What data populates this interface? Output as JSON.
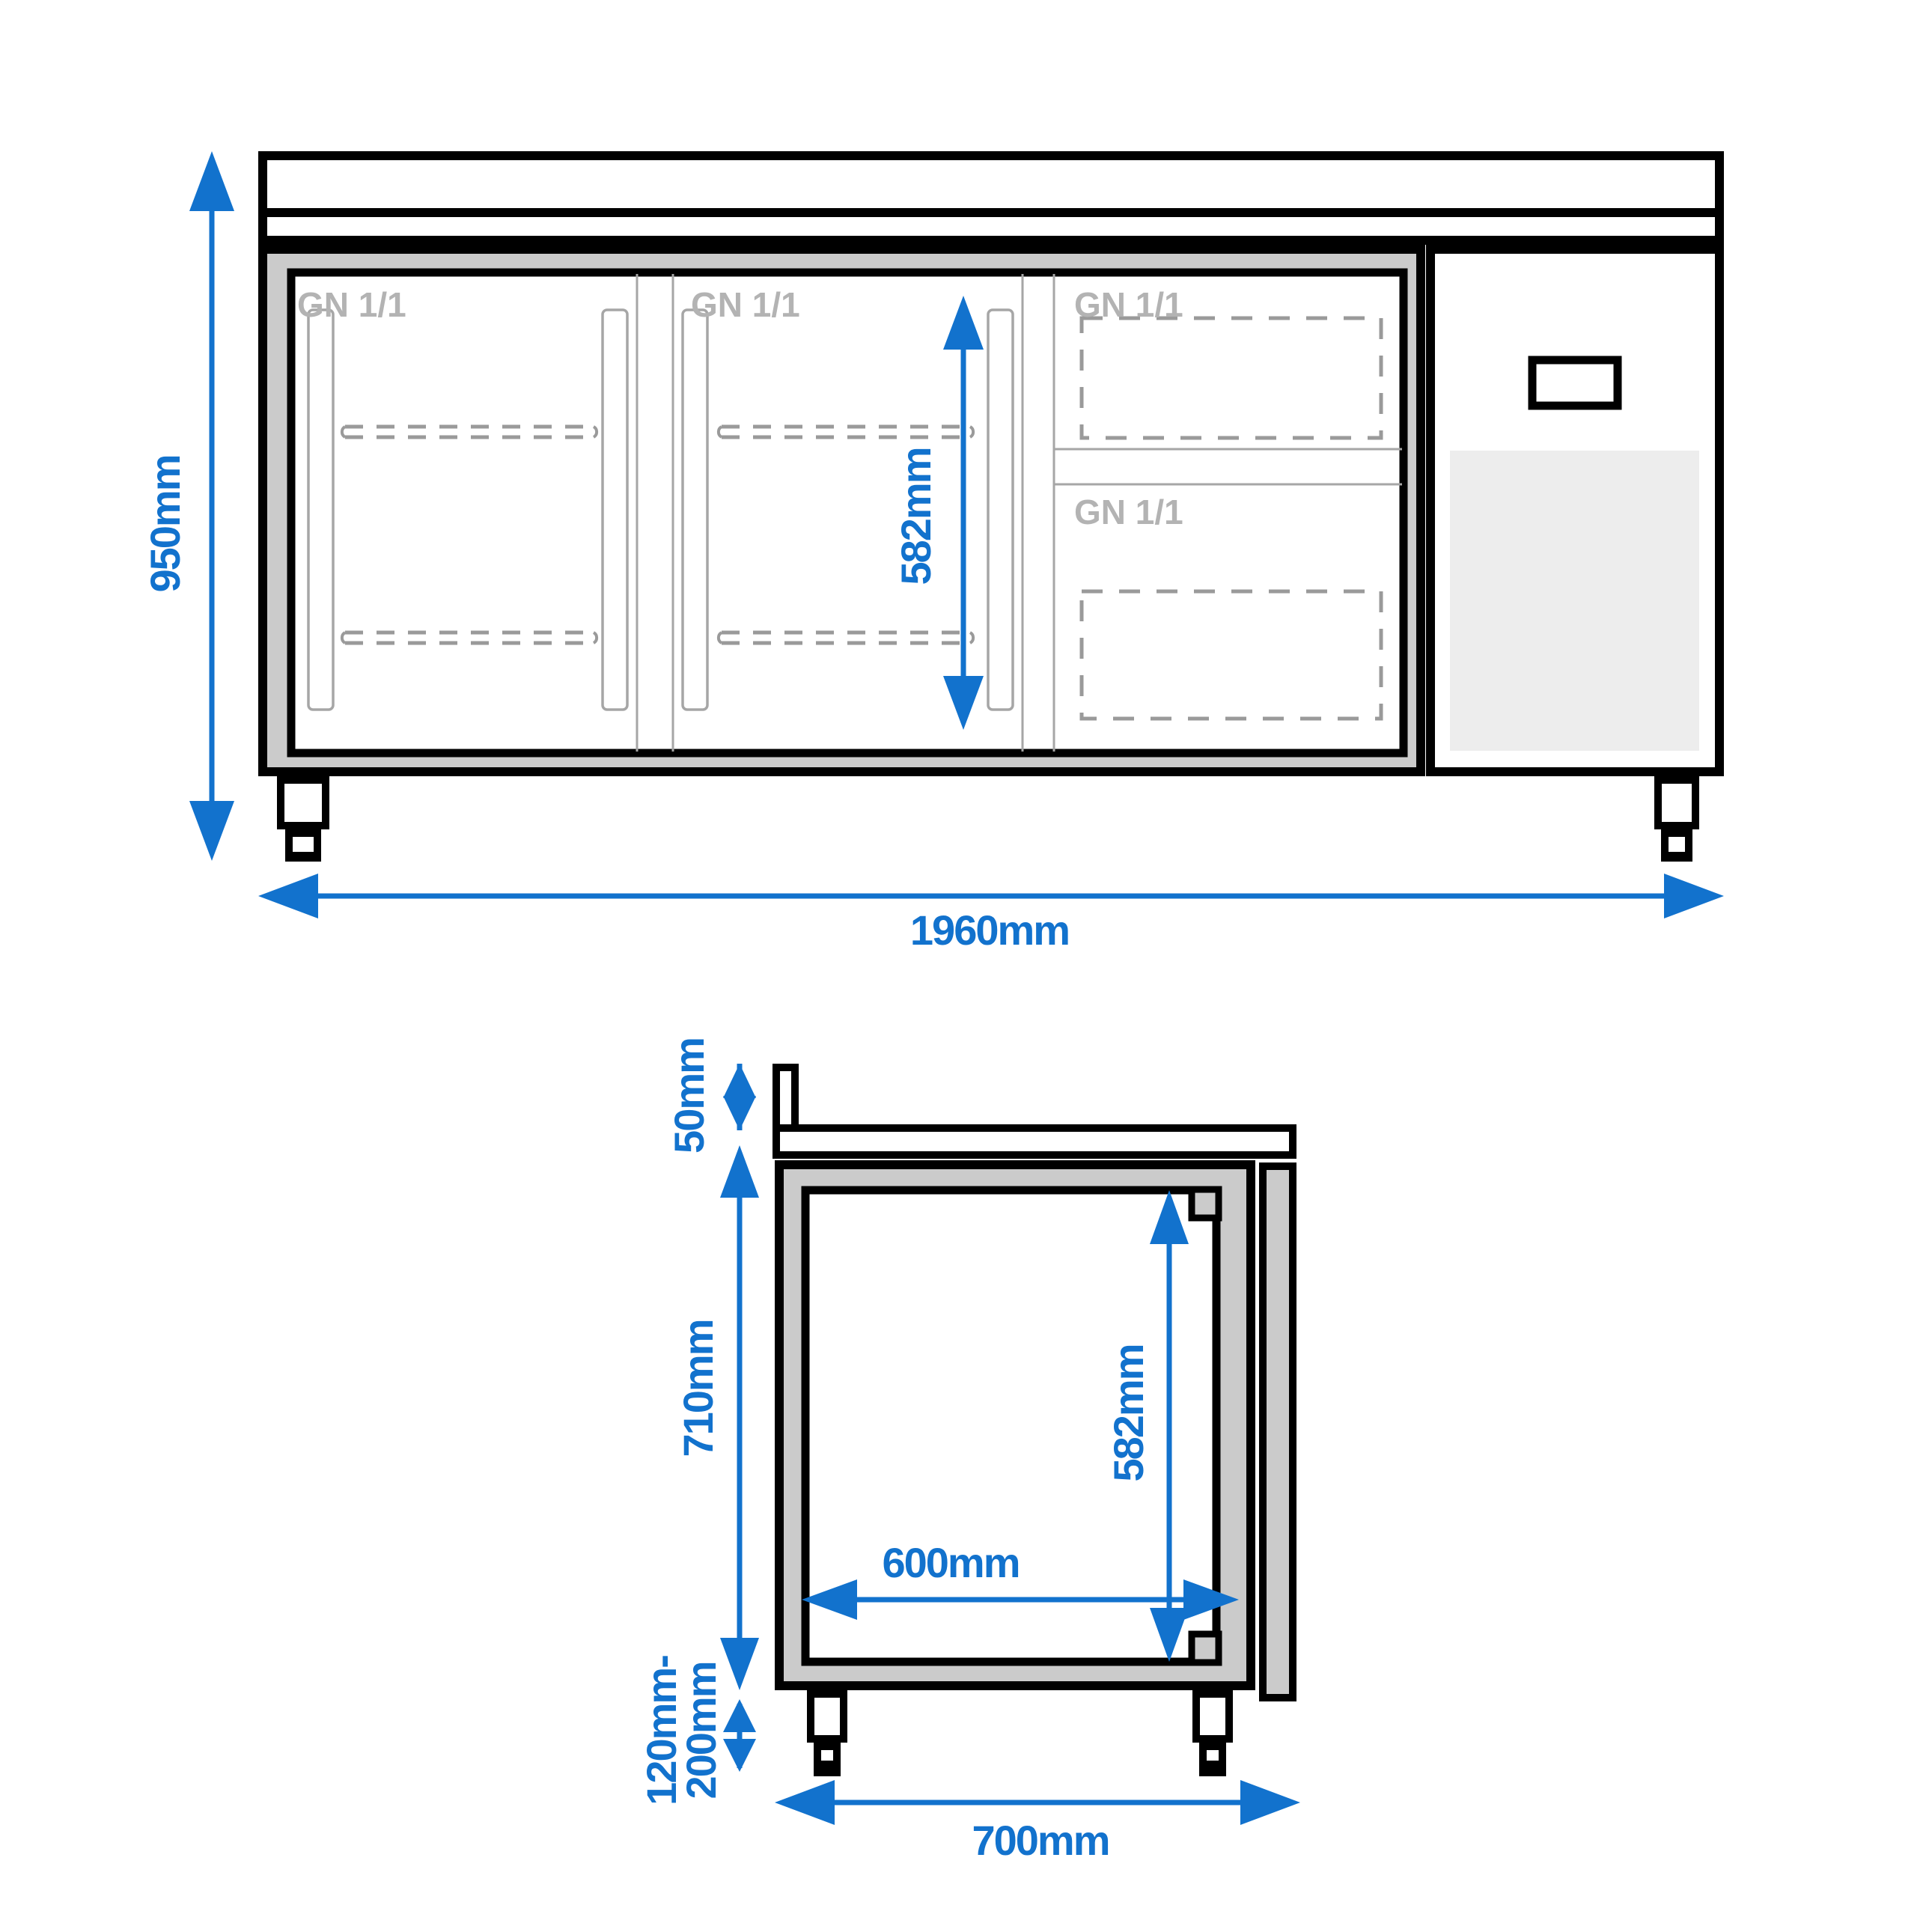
{
  "front": {
    "gn_labels": [
      "GN 1/1",
      "GN 1/1",
      "GN 1/1",
      "GN 1/1"
    ],
    "height": "950mm",
    "width": "1960mm",
    "interior_height": "582mm"
  },
  "side": {
    "backsplash_height": "50mm",
    "body_height": "710mm",
    "feet_min": "120mm-",
    "feet_max": "200mm",
    "depth": "700mm",
    "interior_depth": "600mm",
    "interior_height": "582mm"
  },
  "colors": {
    "dimension_blue": "#1272cd",
    "carcass_gray": "#cbcbcb",
    "vent_gray": "#ededed",
    "label_gray": "#b3b3b3",
    "line_gray": "#a6a6a6",
    "outline_black": "#000000",
    "background": "#ffffff"
  }
}
